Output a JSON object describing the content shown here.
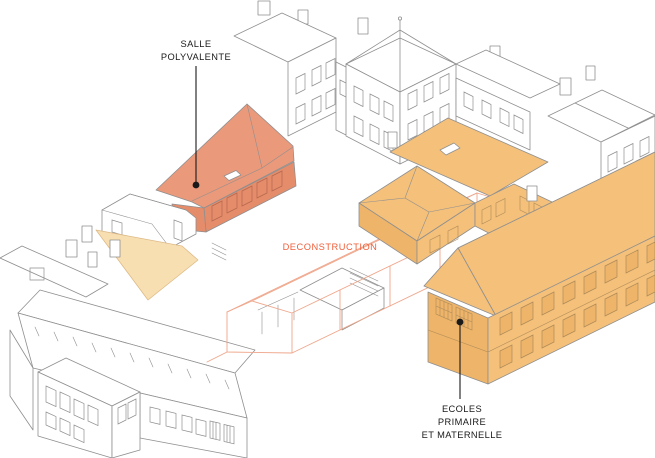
{
  "colors": {
    "background": "#FFFFFF",
    "line": "#8F8F8F",
    "salmon": "#EB997B",
    "salmon_dark": "#E58C6B",
    "salmon_line": "#B5674D",
    "orange": "#F4C07A",
    "orange_dark": "#EEB469",
    "orange_line": "#AD8A58",
    "tan": "#F8DFB2",
    "tan_edge": "#DDBA86",
    "demolition_line": "#EFA68B",
    "demolition_text": "#F0603C",
    "label_text": "#1A1A1A"
  },
  "labels": {
    "salle_polyvalente": {
      "line1": "SALLE",
      "line2": "POLYVALENTE"
    },
    "deconstruction": {
      "text": "DECONSTRUCTION"
    },
    "ecoles": {
      "line1": "ECOLES",
      "line2": "PRIMAIRE",
      "line3": "ET MATERNELLE"
    }
  }
}
